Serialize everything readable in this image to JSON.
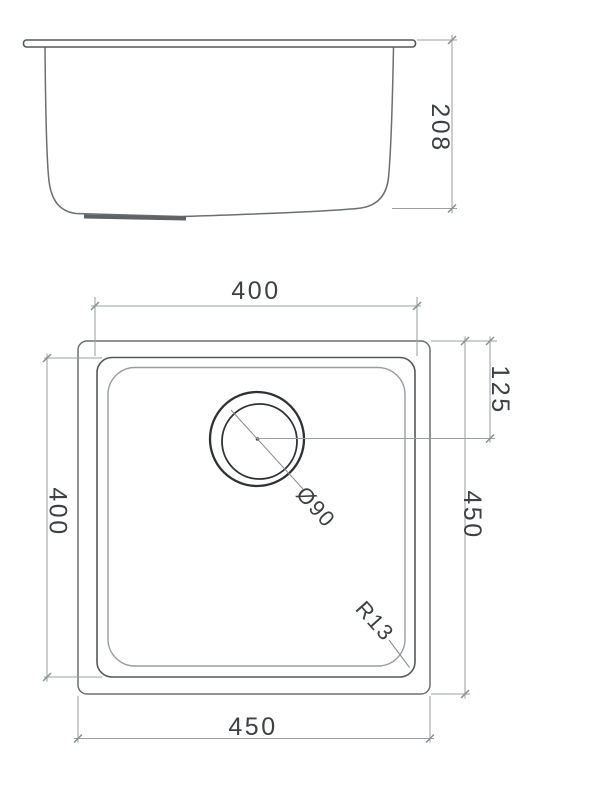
{
  "drawing_title": "sink-technical-drawing",
  "colors": {
    "background": "#ffffff",
    "outline": "#6b6f71",
    "outline_dark": "#54585a",
    "outline_light": "#999d9f",
    "dim": "#9ba1a3",
    "tick": "#8a8f92",
    "drain": "#2f3234",
    "text": "#3e4144"
  },
  "side_view": {
    "depth": "208"
  },
  "plan_view": {
    "inner_width": "400",
    "inner_height": "400",
    "outer_width": "450",
    "outer_height": "450",
    "drain_offset": "125",
    "drain_diameter": "Ø90",
    "corner_radius": "R13"
  }
}
